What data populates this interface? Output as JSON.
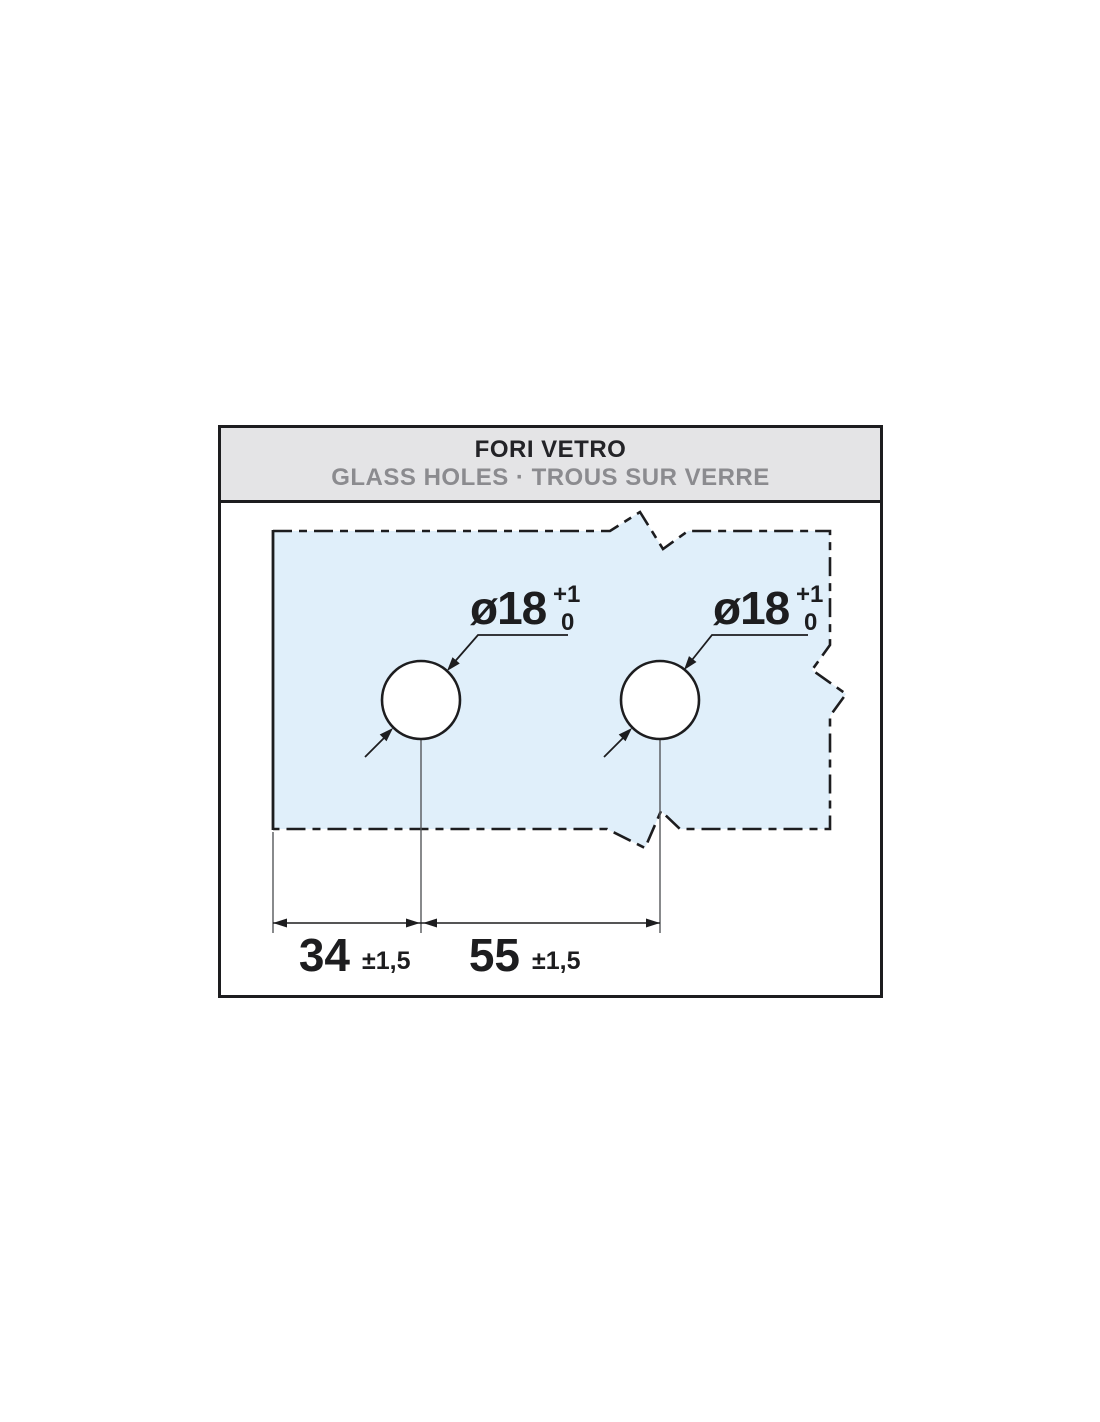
{
  "header": {
    "title": "FORI VETRO",
    "subtitle": "GLASS HOLES · TROUS SUR VERRE"
  },
  "glass": {
    "hole_labels": [
      {
        "diameter": "ø18",
        "tol_upper": "+1",
        "tol_lower": "0"
      },
      {
        "diameter": "ø18",
        "tol_upper": "+1",
        "tol_lower": "0"
      }
    ],
    "dimensions": [
      {
        "value": "34",
        "tolerance": "±1,5"
      },
      {
        "value": "55",
        "tolerance": "±1,5"
      }
    ]
  },
  "colors": {
    "glass_fill": "#e0effa",
    "line": "#1d1d1f",
    "header_bg": "#e4e4e6",
    "title_text": "#232327",
    "subtitle_text": "#8b8b8f",
    "extension_line": "#55575a"
  }
}
